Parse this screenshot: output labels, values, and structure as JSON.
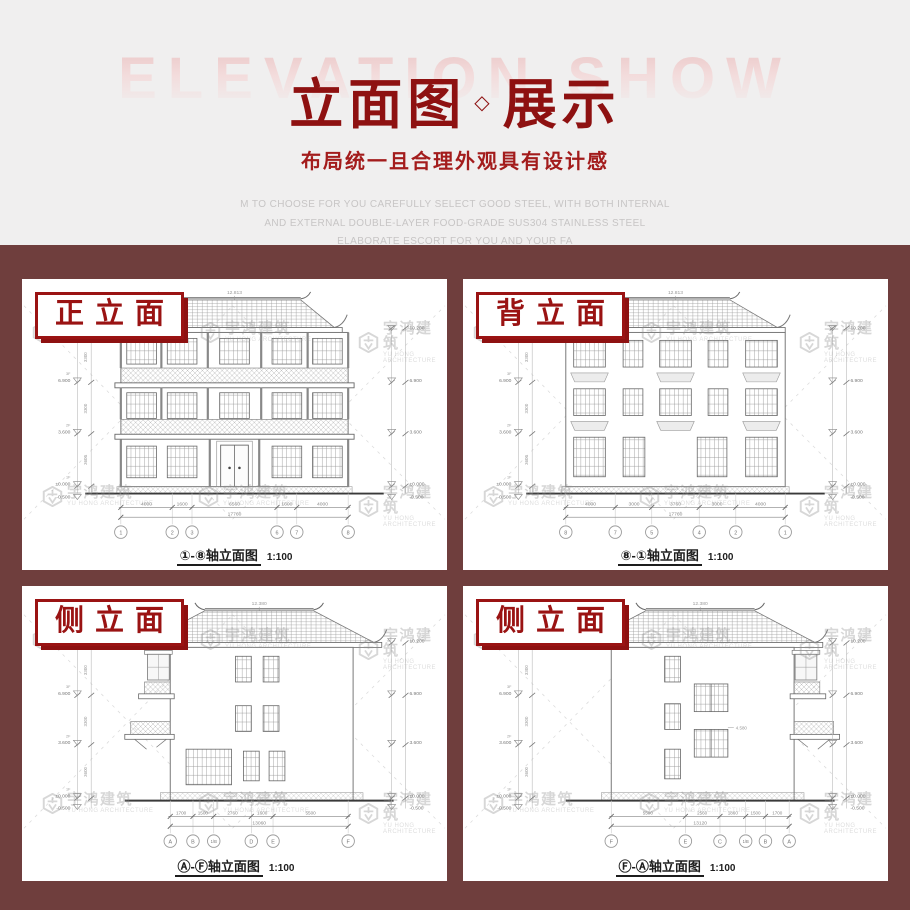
{
  "hero": {
    "ghost": "ELEVATION SHOW",
    "title_left": "立面图",
    "title_sep": "◇",
    "title_right": "展示",
    "subtitle": "布局统一且合理外观具有设计感",
    "desc_lines": [
      "M TO CHOOSE FOR YOU CAREFULLY SELECT GOOD STEEL, WITH BOTH INTERNAL",
      "AND EXTERNAL DOUBLE-LAYER FOOD-GRADE SUS304 STAINLESS STEEL",
      "ELABORATE ESCORT FOR YOU AND YOUR FA"
    ]
  },
  "watermark": {
    "text": "宇鸿建筑",
    "subtext": "YU HONG ARCHITECTURE",
    "positions": [
      [
        10,
        42
      ],
      [
        178,
        42
      ],
      [
        336,
        42
      ],
      [
        20,
        206
      ],
      [
        176,
        206
      ],
      [
        336,
        206
      ]
    ]
  },
  "colors": {
    "brand_red": "#8e1111",
    "label_red": "#9a1313",
    "page_brown": "#6f3e3d",
    "hero_bg": "#f0efef",
    "watermark_gray": "#8d8d8d"
  },
  "panels": [
    {
      "label": "正立面",
      "caption": "①-⑧轴立面图",
      "scale": "1:100",
      "ridge": "12.813",
      "levels": [
        "10.200",
        "6.900",
        "3.600",
        "±0.000",
        "-0.500"
      ],
      "floors": [
        "3F",
        "2F",
        "1F"
      ],
      "floor_heights": [
        "3300",
        "3300",
        "3600"
      ],
      "dims": [
        "4000",
        "1600",
        "6560",
        "1600",
        "4000"
      ],
      "total": "17760",
      "axes": [
        "1",
        "2",
        "3",
        "6",
        "7",
        "8"
      ]
    },
    {
      "label": "背立面",
      "caption": "⑧-①轴立面图",
      "scale": "1:100",
      "ridge": "12.813",
      "levels": [
        "10.200",
        "6.900",
        "3.600",
        "±0.000",
        "-0.500"
      ],
      "floors": [
        "3F",
        "2F",
        "1F"
      ],
      "floor_heights": [
        "3300",
        "3300",
        "3600"
      ],
      "dims": [
        "4000",
        "3000",
        "3760",
        "3000",
        "4000"
      ],
      "total": "17760",
      "axes": [
        "8",
        "7",
        "5",
        "4",
        "2",
        "1"
      ]
    },
    {
      "label": "侧立面",
      "caption": "Ⓐ-Ⓕ轴立面图",
      "scale": "1:100",
      "ridge": "12.380",
      "levels": [
        "10.200",
        "6.900",
        "3.600",
        "±0.000",
        "-0.500"
      ],
      "floors": [
        "3F",
        "2F",
        "1F"
      ],
      "floor_heights": [
        "3300",
        "3300",
        "3600"
      ],
      "dims": [
        "1700",
        "1500",
        "2760",
        "1600",
        "5500"
      ],
      "total": "13060",
      "axes": [
        "A",
        "B",
        "1/B",
        "D",
        "E",
        "F"
      ]
    },
    {
      "label": "侧立面",
      "caption": "Ⓕ-Ⓐ轴立面图",
      "scale": "1:100",
      "ridge": "12.380",
      "levels": [
        "10.200",
        "6.900",
        "3.600",
        "±0.000",
        "-0.500"
      ],
      "floors": [
        "3F",
        "2F",
        "1F"
      ],
      "floor_heights": [
        "3300",
        "3300",
        "3600"
      ],
      "dims": [
        "5500",
        "2560",
        "1860",
        "1500",
        "1700"
      ],
      "total": "13120",
      "mid_level": "4.580",
      "axes": [
        "F",
        "E",
        "C",
        "1/B",
        "B",
        "A"
      ]
    }
  ]
}
